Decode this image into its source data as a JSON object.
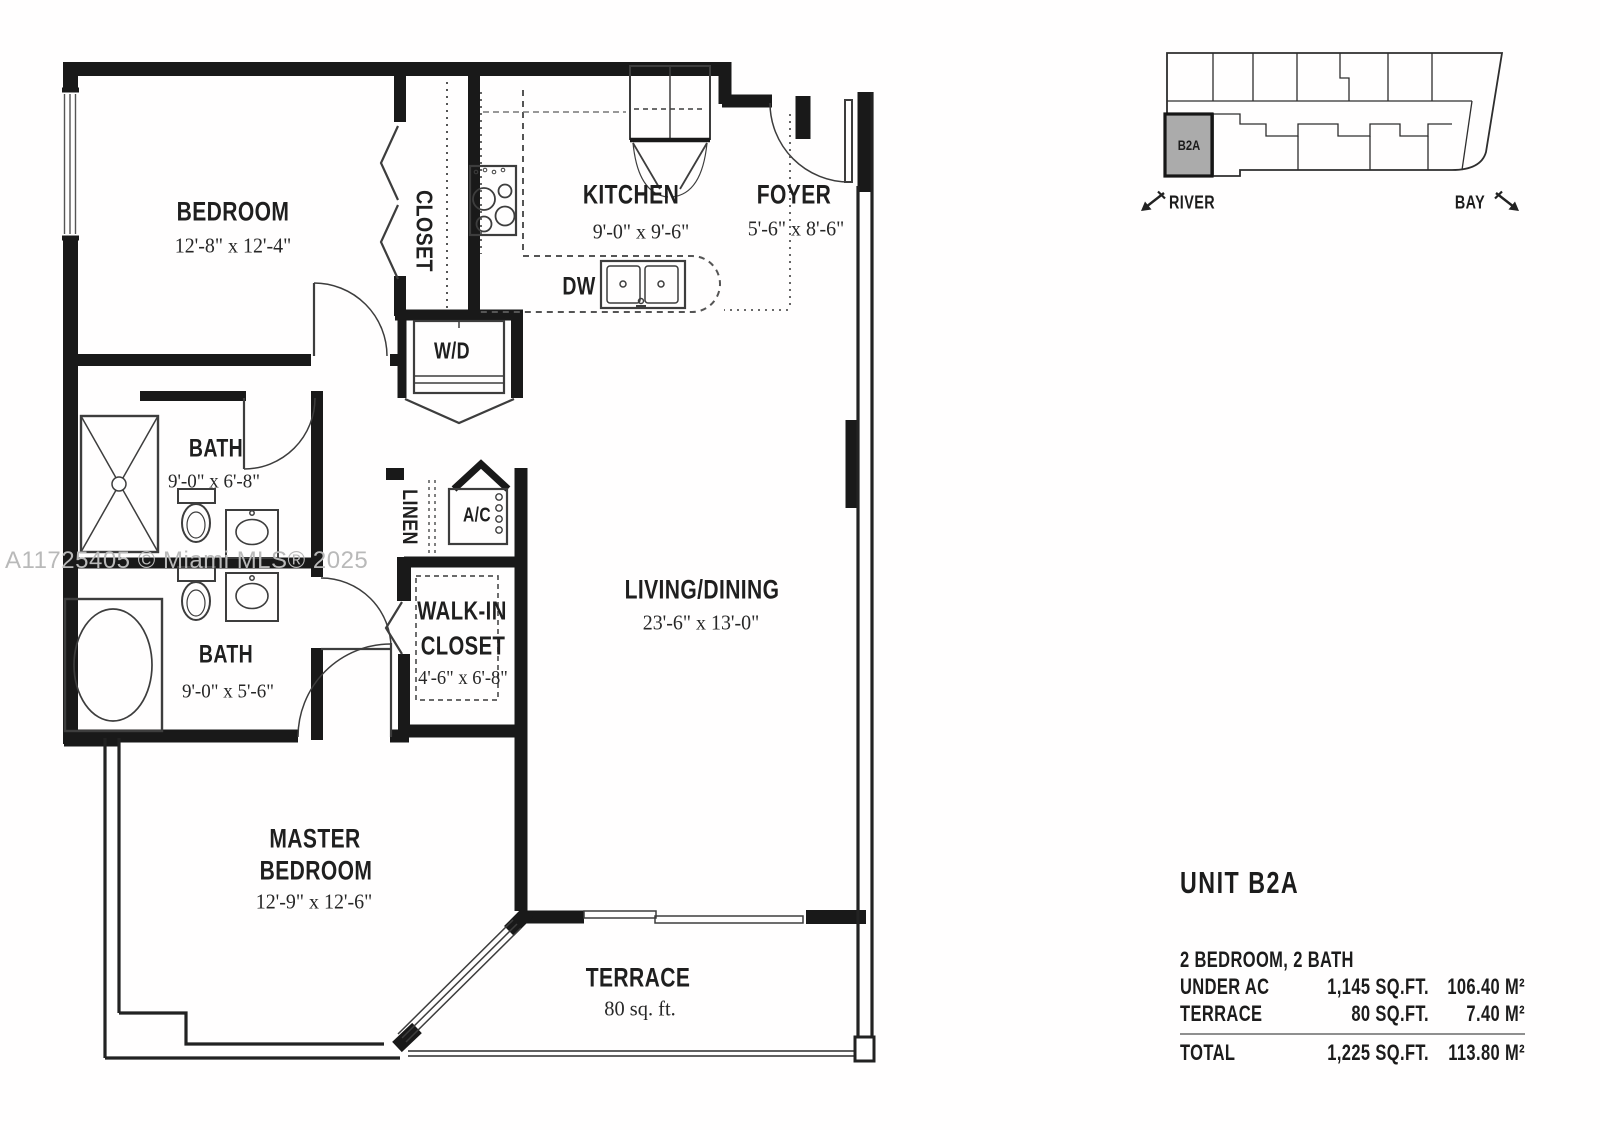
{
  "watermark": "A11725405 © Miami MLS® 2025",
  "colors": {
    "wall": "#191919",
    "thin_line": "#3d3d3d",
    "dashed": "#555555",
    "watermark": "#b9b9b9",
    "keyplan_unit_fill": "#ababab"
  },
  "labels": {
    "bedroom": {
      "name": "BEDROOM",
      "dims": "12'-8\" x 12'-4\""
    },
    "closet": {
      "name": "CLOSET"
    },
    "kitchen": {
      "name": "KITCHEN",
      "dims": "9'-0\" x 9'-6\""
    },
    "foyer": {
      "name": "FOYER",
      "dims": "5'-6\" x 8'-6\""
    },
    "dw": {
      "name": "DW"
    },
    "wd": {
      "name": "W/D"
    },
    "bath1": {
      "name": "BATH",
      "dims": "9'-0\" x 6'-8\""
    },
    "linen": {
      "name": "LINEN"
    },
    "ac": {
      "name": "A/C"
    },
    "bath2": {
      "name": "BATH",
      "dims": "9'-0\" x 5'-6\""
    },
    "walk_in": {
      "line1": "WALK-IN",
      "line2": "CLOSET",
      "dims": "4'-6\" x 6'-8\""
    },
    "living": {
      "name": "LIVING/DINING",
      "dims": "23'-6\" x 13'-0\""
    },
    "master": {
      "line1": "MASTER",
      "line2": "BEDROOM",
      "dims": "12'-9\" x 12'-6\""
    },
    "terrace": {
      "name": "TERRACE",
      "area": "80 sq. ft."
    }
  },
  "key_plan": {
    "unit": "B2A",
    "river": "RIVER",
    "bay": "BAY"
  },
  "unit_info": {
    "title": "UNIT B2A",
    "subtitle": "2 BEDROOM, 2 BATH",
    "rows": [
      {
        "label": "UNDER AC",
        "sqft": "1,145 SQ.FT.",
        "m2": "106.40 M²"
      },
      {
        "label": "TERRACE",
        "sqft": "80 SQ.FT.",
        "m2": "7.40 M²"
      }
    ],
    "total": {
      "label": "TOTAL",
      "sqft": "1,225 SQ.FT.",
      "m2": "113.80 M²"
    }
  }
}
